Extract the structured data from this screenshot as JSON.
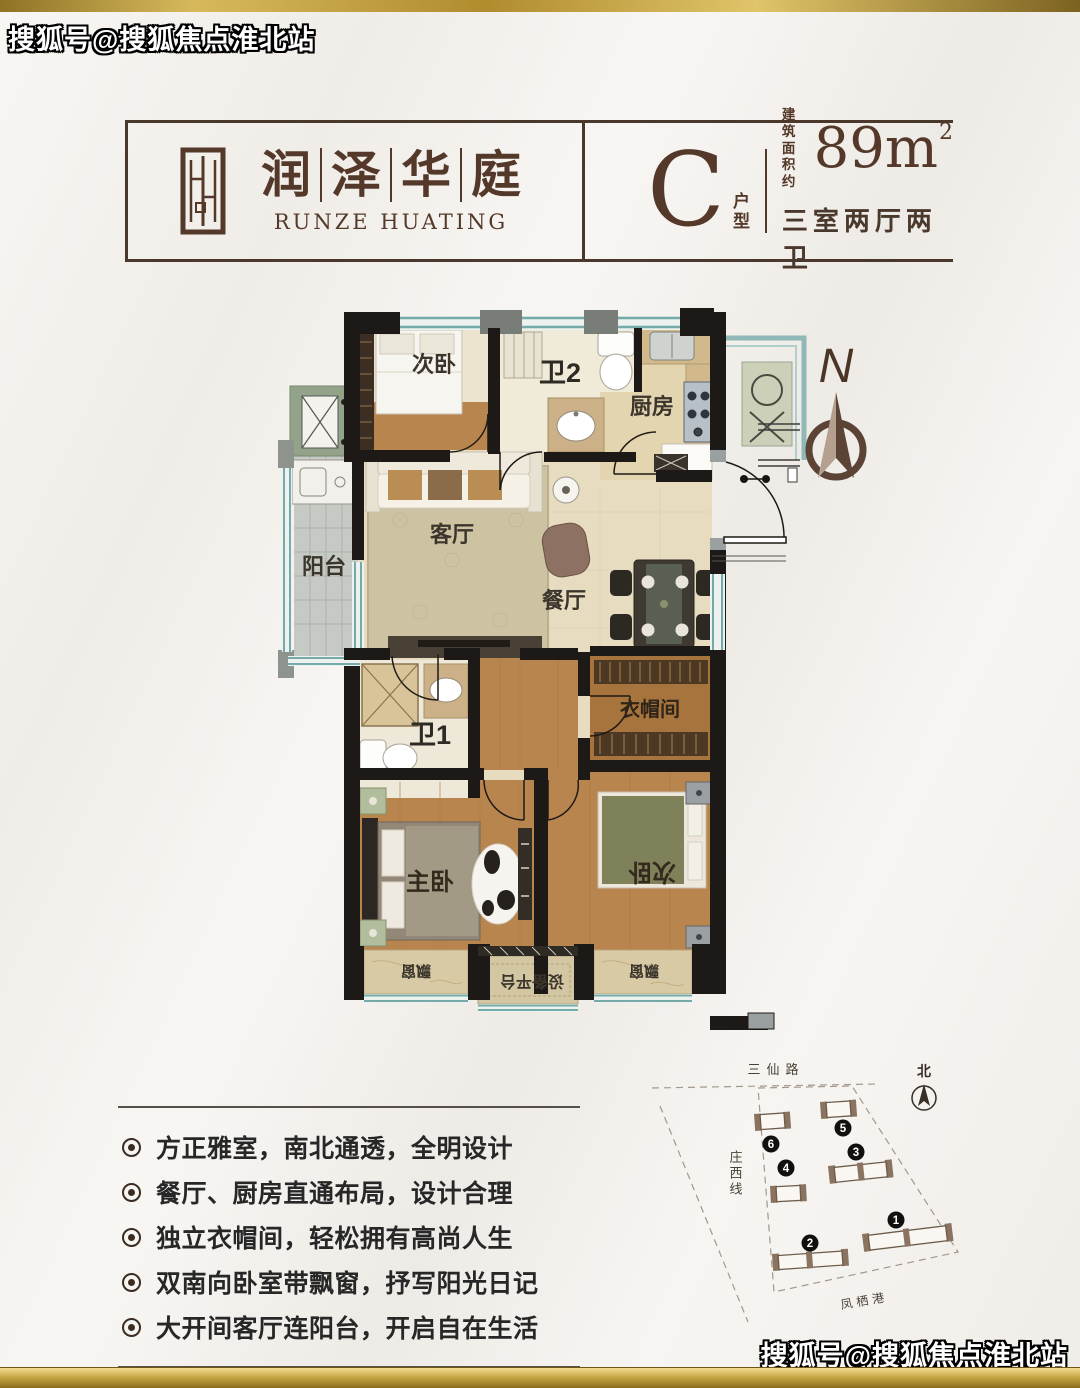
{
  "watermark": {
    "text": "搜狐号@搜狐焦点淮北站"
  },
  "header": {
    "brand_cn": [
      "润",
      "泽",
      "华",
      "庭"
    ],
    "brand_en": "RUNZE HUATING",
    "unit_letter": "C",
    "unit_type_label": "户型",
    "area_label_line1": "建 筑",
    "area_label_line2": "面积约",
    "area_value": "89m",
    "area_exponent": "2",
    "rooms_summary": "三室两厅两卫"
  },
  "floorplan": {
    "compass": "N",
    "rooms": {
      "bedroom_top": "次卧",
      "bath2": "卫2",
      "kitchen": "厨房",
      "balcony": "阳台",
      "living": "客厅",
      "dining": "餐厅",
      "bath1": "卫1",
      "closet": "衣帽间",
      "master": "主卧",
      "bedroom_bottom": "次卧",
      "bay_window": "飘窗",
      "equipment_platform": "设备平台"
    }
  },
  "features": {
    "items": [
      "方正雅室，南北通透，全明设计",
      "餐厅、厨房直通布局，设计合理",
      "独立衣帽间，轻松拥有高尚人生",
      "双南向卧室带飘窗，抒写阳光日记",
      "大开间客厅连阳台，开启自在生活"
    ]
  },
  "sitemap": {
    "road_top": "三仙路",
    "road_left": "庄西线",
    "waterway_bottom": "凤栖港",
    "north_label": "北",
    "buildings": [
      "1",
      "2",
      "3",
      "4",
      "5",
      "6"
    ]
  },
  "colors": {
    "gold": "#b6933a",
    "brand_brown": "#54392a",
    "wall_black": "#1d1916",
    "wood_floor": "#b9854f",
    "tile_floor": "#e7dcc0",
    "window_teal": "#74aaa8",
    "balcony_gray": "#c6cac4"
  }
}
